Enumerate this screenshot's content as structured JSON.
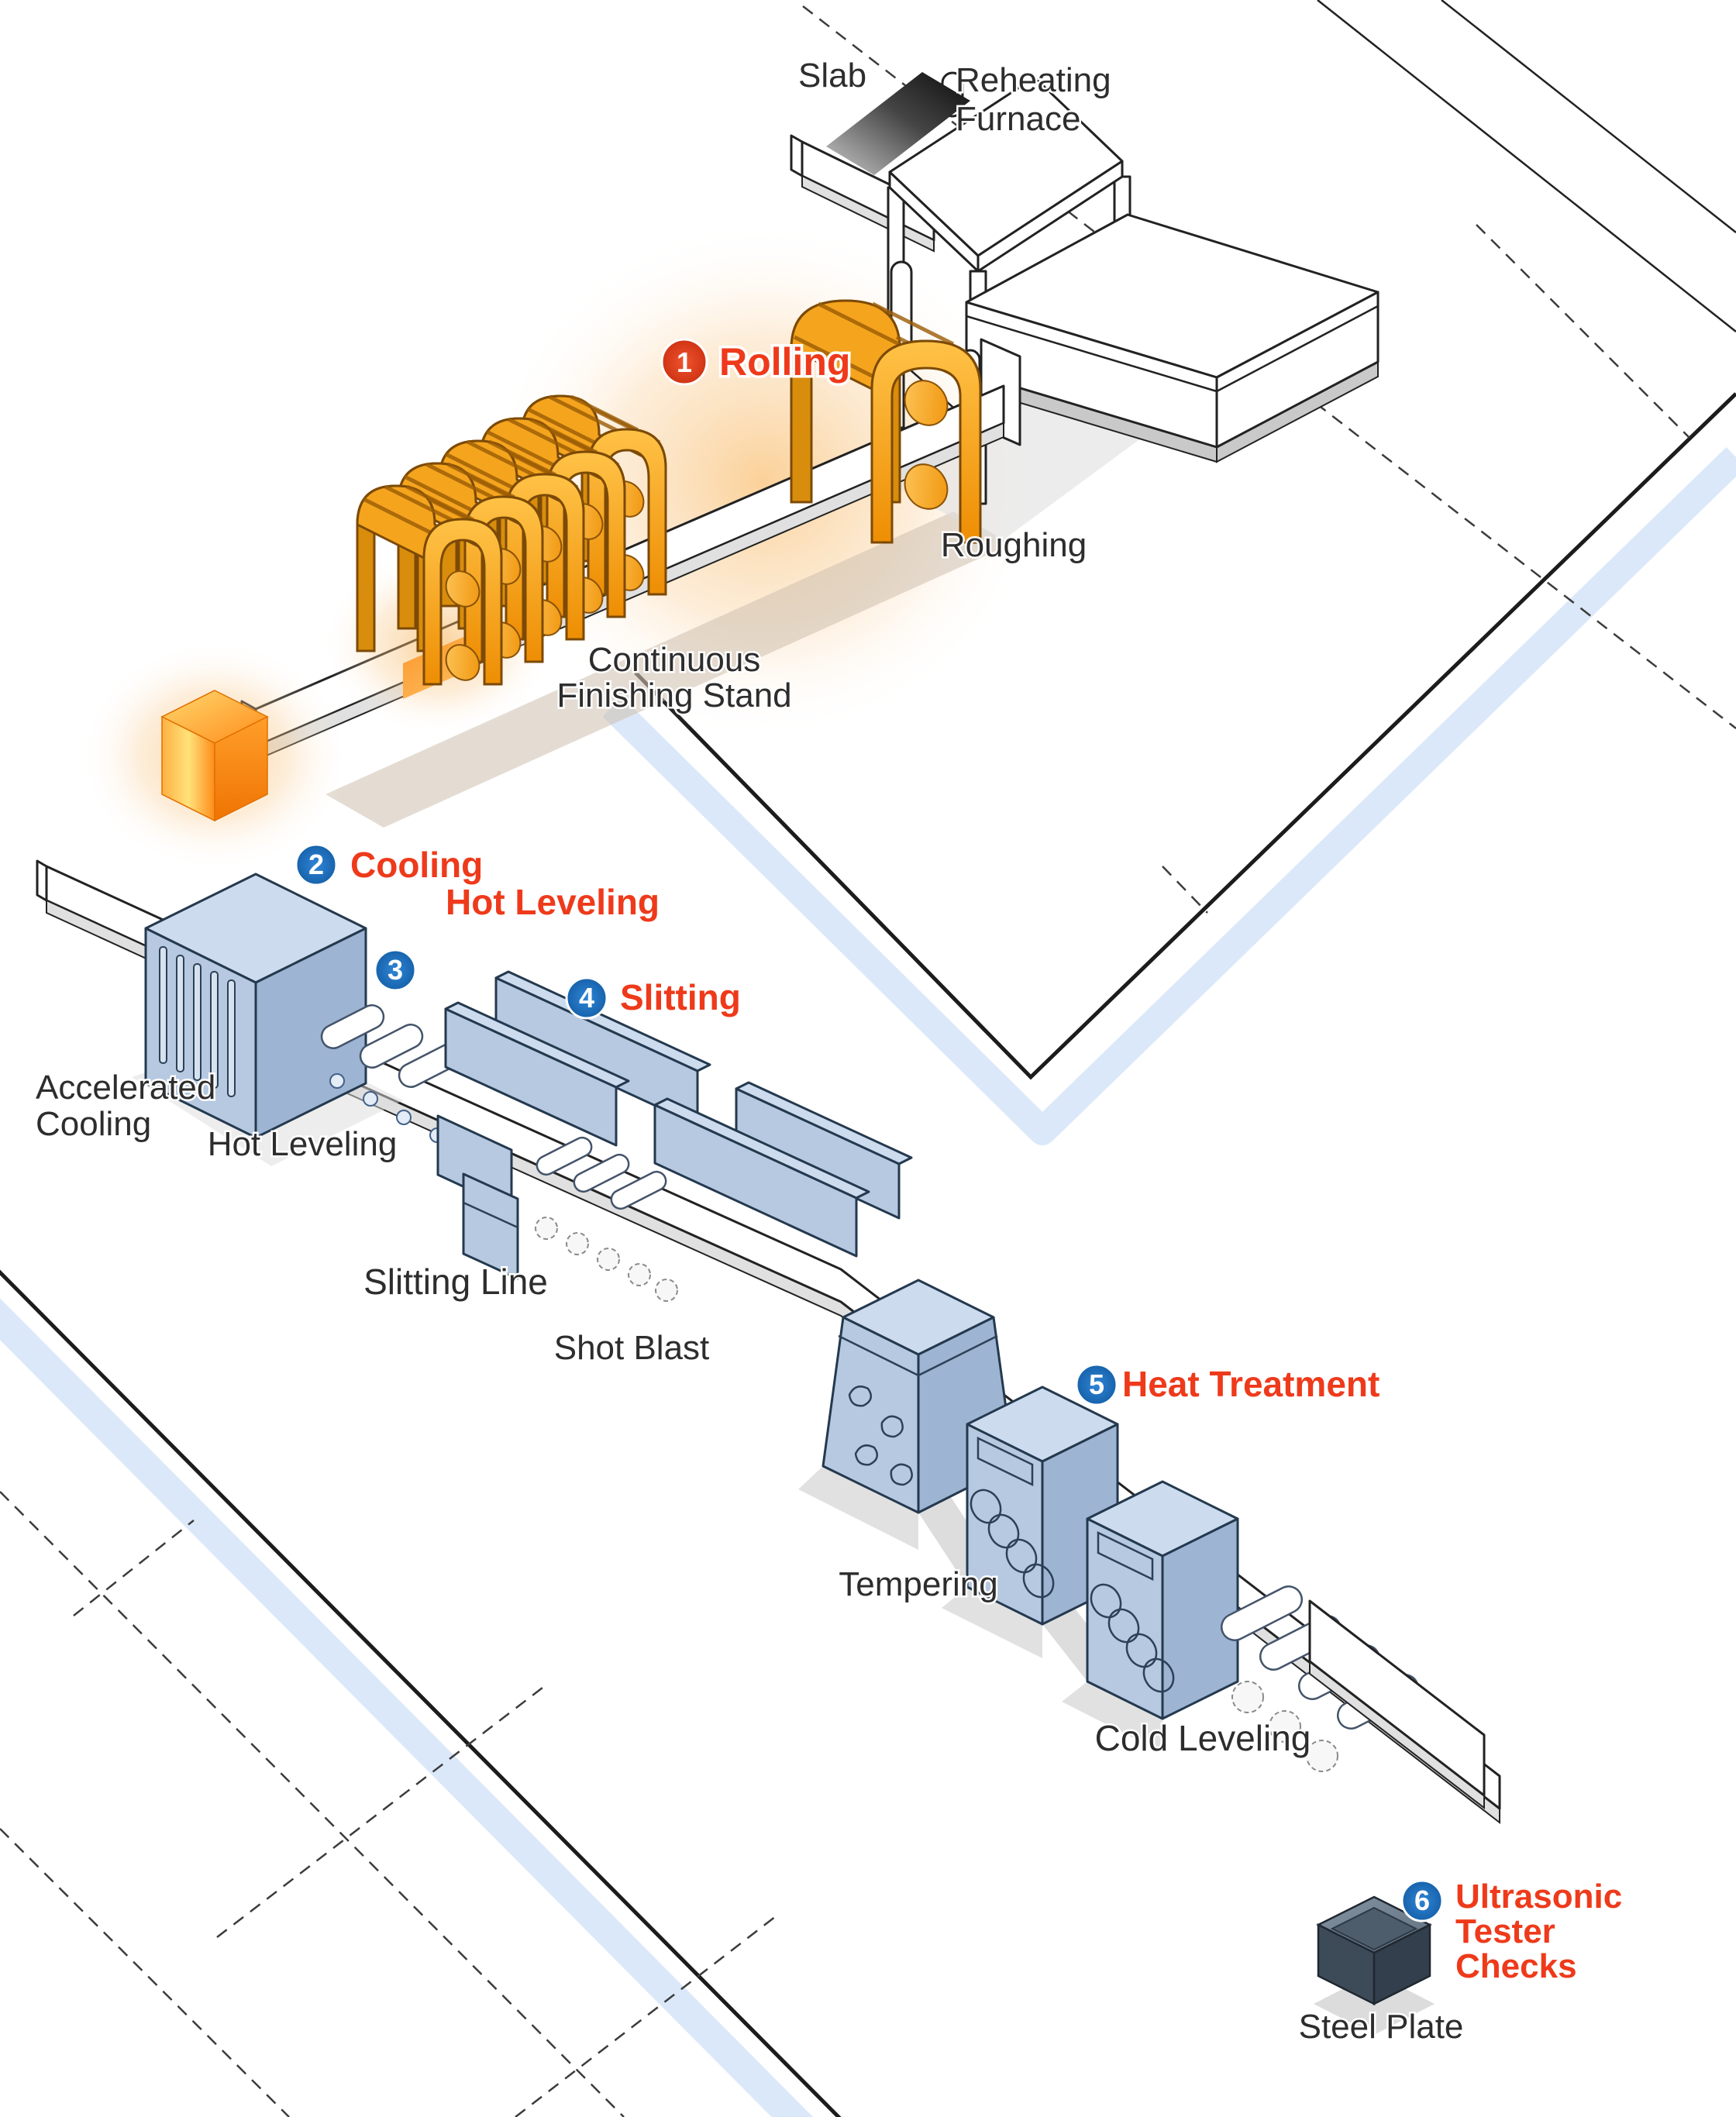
{
  "diagram": {
    "subject": "Steel plate manufacturing process flow",
    "steps": [
      {
        "number": "1",
        "label": "Rolling"
      },
      {
        "number": "2",
        "label": "Cooling"
      },
      {
        "number": "3",
        "label": "Hot Leveling"
      },
      {
        "number": "4",
        "label": "Slitting"
      },
      {
        "number": "5",
        "label": "Heat Treatment"
      },
      {
        "number": "6",
        "label": "Ultrasonic Tester Checks",
        "lines": {
          "l1": "Ultrasonic",
          "l2": "Tester",
          "l3": "Checks"
        }
      }
    ],
    "equipment_labels": {
      "slab": "Slab",
      "reheating_furnace": {
        "line1": "Reheating",
        "line2": "Furnace"
      },
      "roughing": "Roughing",
      "continuous_finishing_stand": {
        "line1": "Continuous",
        "line2": "Finishing Stand"
      },
      "accelerated_cooling": {
        "line1": "Accelerated",
        "line2": "Cooling"
      },
      "hot_leveling": "Hot Leveling",
      "slitting_line": "Slitting Line",
      "shot_blast": "Shot Blast",
      "tempering": "Tempering",
      "cold_leveling": "Cold Leveling",
      "steel_plate": "Steel Plate"
    },
    "colors": {
      "step_label_red": "#ee3a1b",
      "badge_red": "#d9411f",
      "badge_blue": "#1d71c2",
      "label_black": "#2d2d2d",
      "machine_orange": "#f2990f",
      "machine_blue": "#b6c9e1",
      "walkway_stripe_blue": "#d5e4f8",
      "hot_steel_glow": "#f7ab45"
    }
  }
}
